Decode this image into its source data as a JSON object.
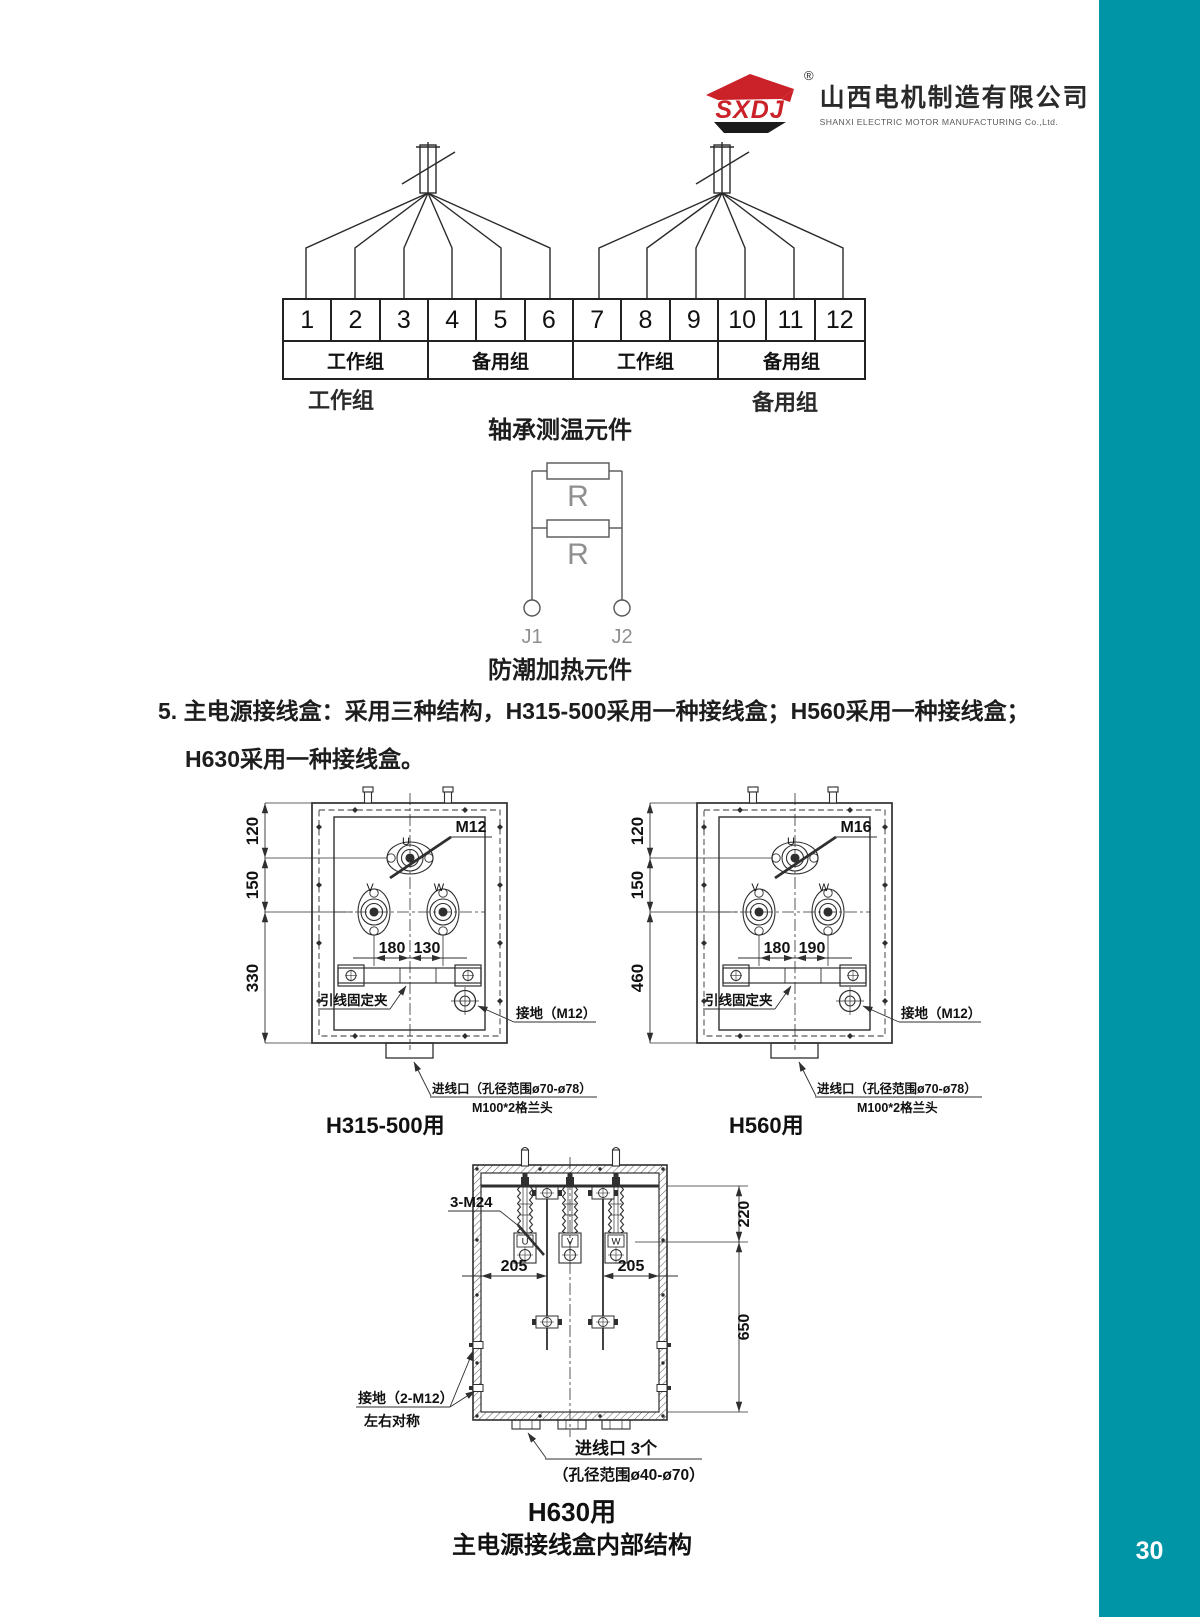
{
  "page": {
    "number": "30"
  },
  "colors": {
    "teal": "#0095a6",
    "logo_red": "#cb2128",
    "line": "#2f2f2f"
  },
  "logo": {
    "mark": "SXDJ",
    "registered": "®",
    "company_cn": "山西电机制造有限公司",
    "company_en": "SHANXI ELECTRIC MOTOR MANUFACTURING Co.,Ltd."
  },
  "terminal_diagram": {
    "terminals": [
      "1",
      "2",
      "3",
      "4",
      "5",
      "6",
      "7",
      "8",
      "9",
      "10",
      "11",
      "12"
    ],
    "groups": [
      "工作组",
      "备用组",
      "工作组",
      "备用组"
    ],
    "left_group_label": "工作组",
    "right_group_label": "备用组",
    "caption": "轴承测温元件"
  },
  "heater": {
    "r1": "R",
    "r2": "R",
    "j1": "J1",
    "j2": "J2",
    "caption": "防潮加热元件"
  },
  "note": {
    "line1": "5. 主电源接线盒：采用三种结构，H315-500采用一种接线盒；H560采用一种接线盒；",
    "line2": "H630采用一种接线盒。"
  },
  "box_a": {
    "u": "U",
    "v": "V",
    "w": "W",
    "bolt": "M12",
    "dim_v1": "120",
    "dim_v2": "150",
    "dim_v3": "330",
    "dim_h1": "180",
    "dim_h2": "130",
    "clamp": "引线固定夹",
    "ground": "接地（M12）",
    "entry": "进线口（孔径范围ø70-ø78）",
    "gland": "M100*2格兰头",
    "caption": "H315-500用"
  },
  "box_b": {
    "u": "U",
    "v": "V",
    "w": "W",
    "bolt": "M16",
    "dim_v1": "120",
    "dim_v2": "150",
    "dim_v3": "460",
    "dim_h1": "180",
    "dim_h2": "190",
    "clamp": "引线固定夹",
    "ground": "接地（M12）",
    "entry": "进线口（孔径范围ø70-ø78）",
    "gland": "M100*2格兰头",
    "caption": "H560用"
  },
  "box_c": {
    "u": "U",
    "v": "V",
    "w": "W",
    "bolt": "3-M24",
    "dim_h1": "205",
    "dim_h2": "205",
    "dim_v1": "220",
    "dim_v2": "650",
    "ground1": "接地（2-M12）",
    "ground2": "左右对称",
    "entry1": "进线口 3个",
    "entry2": "（孔径范围ø40-ø70）",
    "caption": "H630用",
    "subcaption": "主电源接线盒内部结构"
  }
}
